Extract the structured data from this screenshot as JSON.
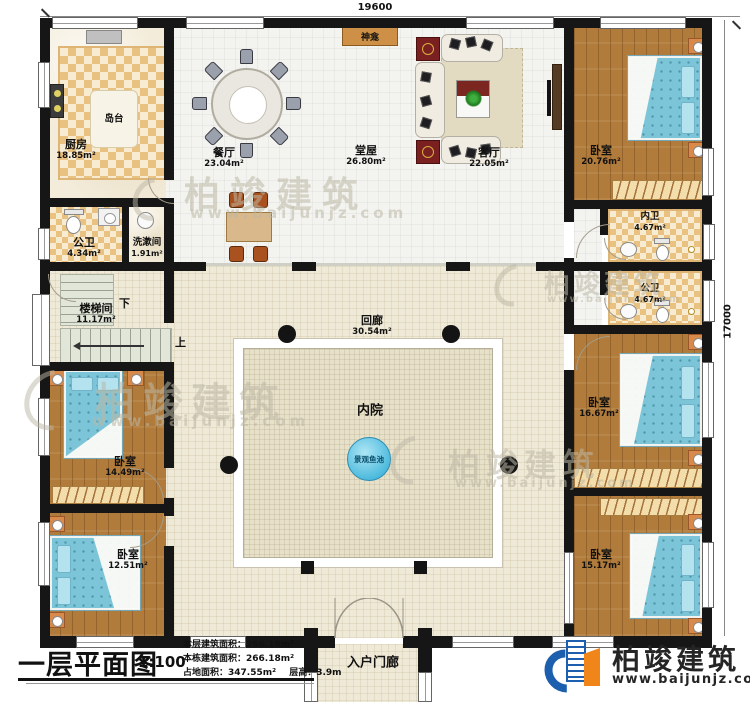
{
  "plan": {
    "dimensions": {
      "top": "19600",
      "right": "17000"
    },
    "stairs": {
      "down": "下",
      "up": "上"
    },
    "rooms": {
      "kitchen": {
        "name": "厨房",
        "area": "18.85m²"
      },
      "island": {
        "name": "岛台"
      },
      "bath1": {
        "name": "公卫",
        "area": "4.34m²"
      },
      "washroom": {
        "name": "洗漱间",
        "area": "1.91m²"
      },
      "dining": {
        "name": "餐厅",
        "area": "23.04m²"
      },
      "hall": {
        "name": "堂屋",
        "area": "26.80m²"
      },
      "shrine": {
        "name": "神龛"
      },
      "living": {
        "name": "客厅",
        "area": "22.05m²"
      },
      "bedroom_tr": {
        "name": "卧室",
        "area": "20.76m²"
      },
      "ensuite": {
        "name": "内卫",
        "area": "4.67m²"
      },
      "bath2": {
        "name": "公卫",
        "area": "4.67m²"
      },
      "stairwell": {
        "name": "楼梯间",
        "area": "11.17m²"
      },
      "corridor": {
        "name": "回廊",
        "area": "30.54m²"
      },
      "courtyard": {
        "name": "内院"
      },
      "pond": {
        "name": "景观鱼池"
      },
      "bedroom_ml": {
        "name": "卧室",
        "area": "14.49m²"
      },
      "bedroom_bl": {
        "name": "卧室",
        "area": "12.51m²"
      },
      "bedroom_mr": {
        "name": "卧室",
        "area": "16.67m²"
      },
      "bedroom_br": {
        "name": "卧室",
        "area": "15.17m²"
      },
      "porch": {
        "name": "入户门廊"
      }
    }
  },
  "title_block": {
    "title": "一层平面图",
    "scale": "1:100",
    "line1": "本层建筑面积：266.18m²",
    "line2": "本栋建筑面积：266.18m²",
    "line3a": "占地面积：347.55m²",
    "line3b": "层高：3.9m"
  },
  "brand": {
    "name": "柏竣建筑",
    "website": "www.baijunjz.com"
  },
  "watermark": {
    "name": "柏竣建筑",
    "website": "www.baijunjz.com"
  },
  "colors": {
    "wall": "#161616",
    "wood": "#b17c3b",
    "bed_blue": "#7cc5d8",
    "brand_blue": "#1b5fae",
    "brand_orange": "#f08519"
  }
}
